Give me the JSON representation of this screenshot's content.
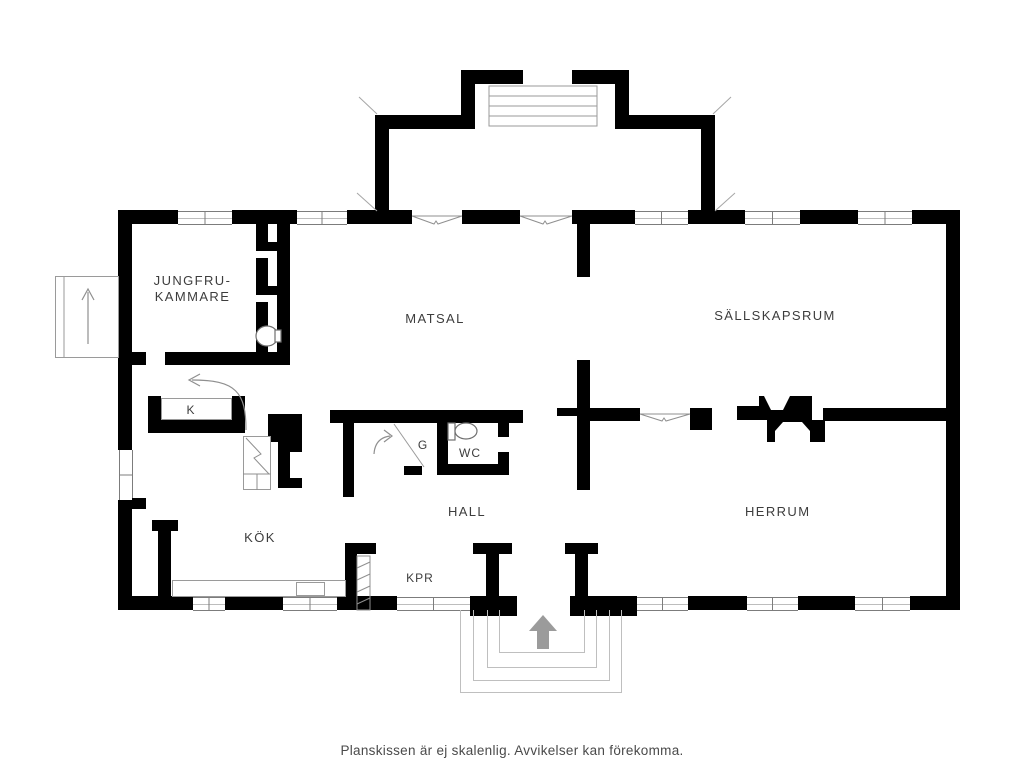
{
  "colors": {
    "wall": "#000000",
    "thin_line": "#9a9a9a",
    "step_line": "#bfbfbf",
    "arrow": "#9b9b9b",
    "text": "#3d3d3d"
  },
  "rooms": {
    "jungfrukammare": {
      "line1": "JUNGFRU-",
      "line2": "KAMMARE"
    },
    "matsal": {
      "label": "MATSAL"
    },
    "sallskapsrum": {
      "label": "SÄLLSKAPSRUM"
    },
    "kok": {
      "label": "KÖK"
    },
    "hall": {
      "label": "HALL"
    },
    "herrum": {
      "label": "HERRUM"
    },
    "wc": {
      "label": "WC"
    },
    "kpr": {
      "label": "KPR"
    },
    "k_closet": {
      "label": "K"
    },
    "g_closet": {
      "label": "G"
    }
  },
  "icons": {
    "entrance_arrow": "up-arrow",
    "side_steps_arrow": "up-arrow",
    "stairs_direction_arrow": "left-arrow",
    "wardrobe_door_arrow": "arc-arrow",
    "toilet": "toilet",
    "fireplace": "double-sided-fireplace"
  },
  "footer": {
    "disclaimer": "Planskissen är ej skalenlig. Avvikelser kan förekomma."
  }
}
